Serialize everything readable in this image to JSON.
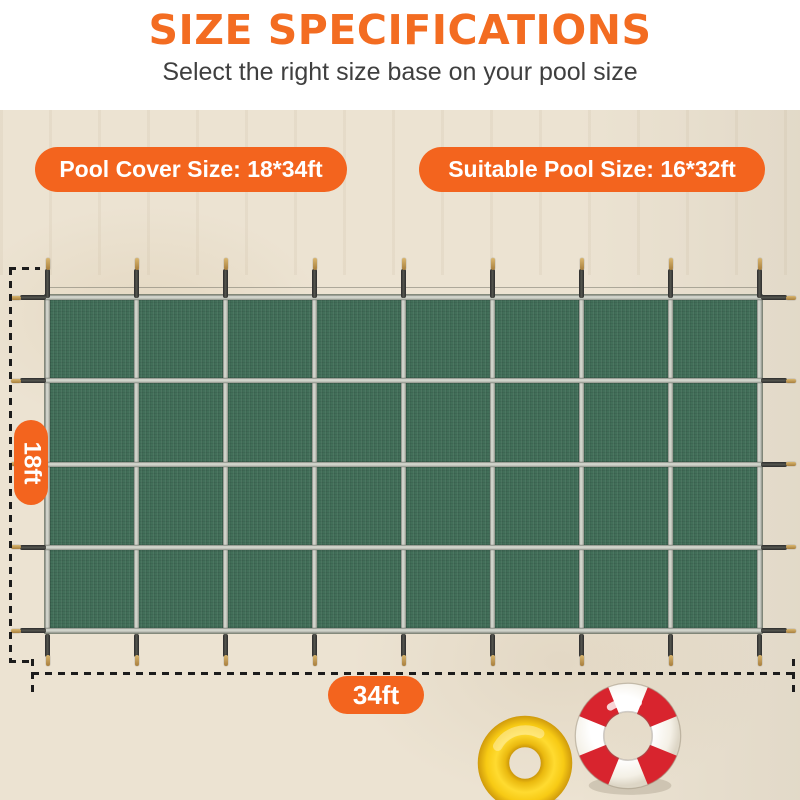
{
  "header": {
    "title": "SIZE SPECIFICATIONS",
    "subtitle": "Select the right size base on your pool size"
  },
  "badges": {
    "cover_size_label": "Pool Cover Size: 18*34ft",
    "pool_size_label": "Suitable Pool Size: 16*32ft"
  },
  "dimensions": {
    "height_label": "18ft",
    "width_label": "34ft"
  },
  "cover": {
    "grid": {
      "columns": 8,
      "rows": 4
    },
    "description": "green-mesh-pool-cover-with-straps-and-anchors"
  },
  "colors": {
    "accent_orange": "#f3641e",
    "title_orange": "#f36c21",
    "subtitle_gray": "#3f3f3f",
    "background_beige": "#ece3d2",
    "cover_green": "#426f59",
    "strap_silver": "#c7cac1",
    "anchor_dark": "#3a3a36",
    "brass_pin": "#b08a4a",
    "lifebuoy_red": "#d8242e",
    "swim_ring_yellow": "#f6cf17"
  },
  "decor": {
    "swim_ring": "yellow-swim-ring",
    "lifebuoy": "red-white-lifebuoy"
  }
}
